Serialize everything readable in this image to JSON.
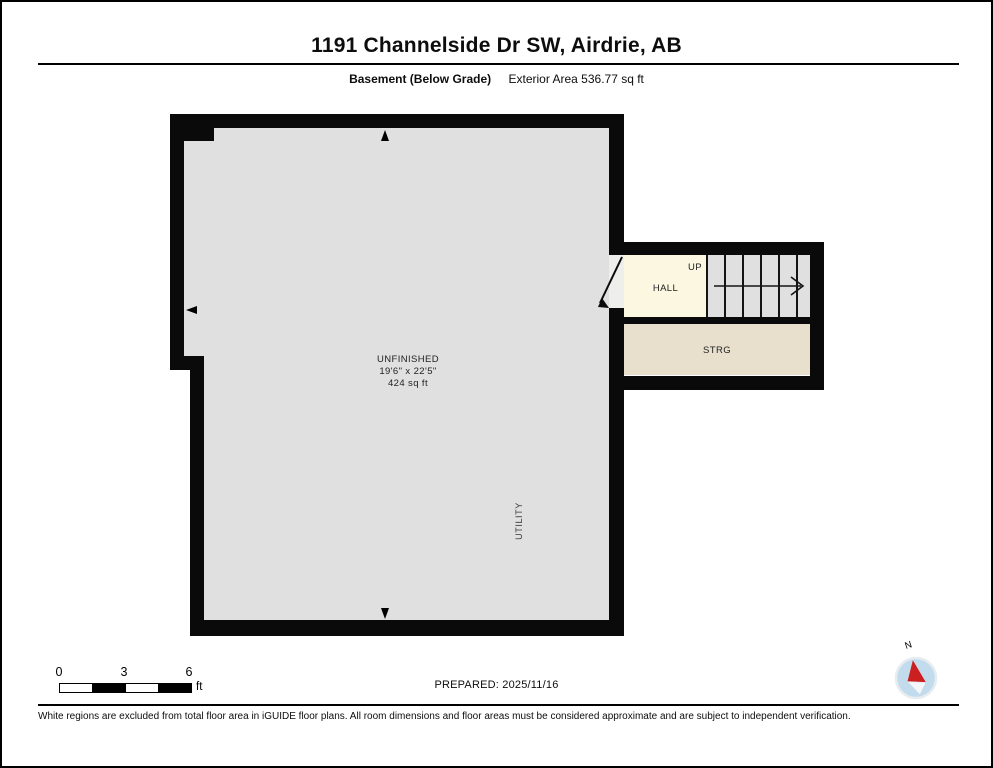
{
  "header": {
    "title": "1191 Channelside Dr SW, Airdrie, AB",
    "floor_label": "Basement (Below Grade)",
    "area_label": "Exterior Area 536.77 sq ft"
  },
  "plan": {
    "rooms": {
      "unfinished": {
        "name": "UNFINISHED",
        "dimensions": "19'6\" x 22'5\"",
        "area": "424 sq ft"
      },
      "hall": {
        "name": "HALL"
      },
      "stairs": {
        "direction_label": "UP",
        "treads": 6
      },
      "storage": {
        "name": "STRG"
      },
      "utility": {
        "name": "UTILITY"
      }
    },
    "colors": {
      "wall": "#0a0a0a",
      "floor_gray": "#e0e0e0",
      "hall_cream": "#fbf7e1",
      "storage_beige": "#e8e0cd"
    }
  },
  "footer": {
    "scale": {
      "ticks": [
        "0",
        "3",
        "6"
      ],
      "unit": "ft"
    },
    "prepared": "PREPARED: 2025/11/16",
    "compass_label": "N",
    "compass_colors": {
      "circle": "#c2dcee",
      "needle": "#cc1f1f"
    },
    "disclaimer": "White regions are excluded from total floor area in iGUIDE floor plans. All room dimensions and floor areas must be considered approximate and are subject to independent verification."
  }
}
